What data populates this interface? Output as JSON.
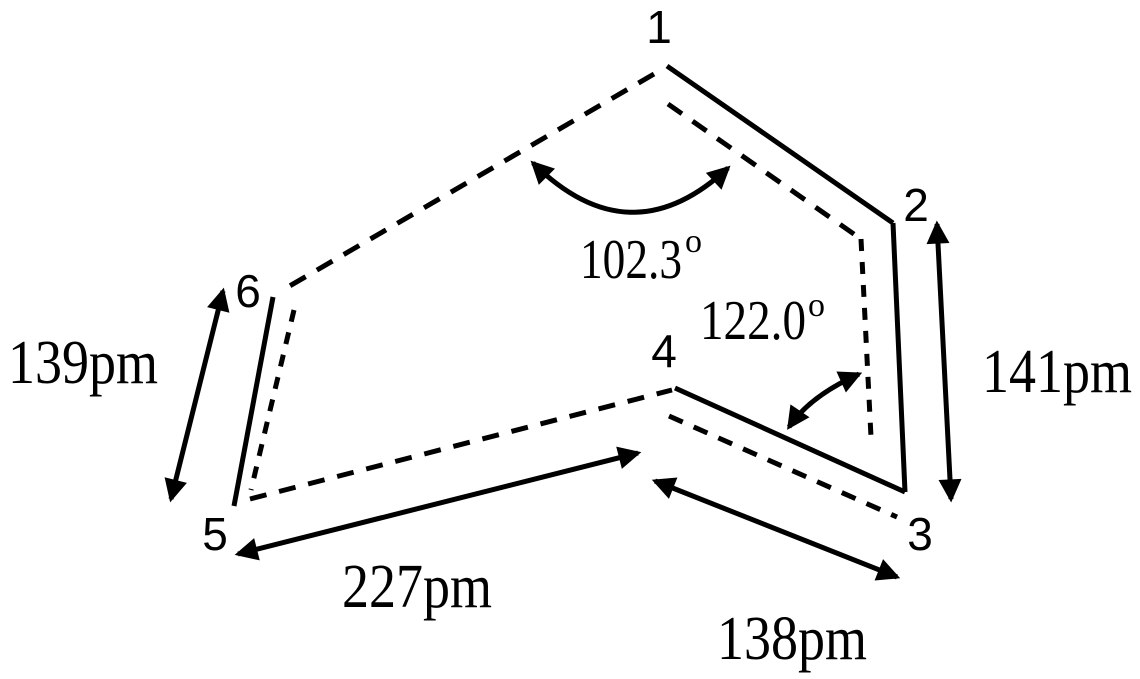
{
  "canvas": {
    "background": "#FFFFFF",
    "ink": "#000000"
  },
  "atoms": [
    {
      "label": "1"
    },
    {
      "label": "2"
    },
    {
      "label": "3"
    },
    {
      "label": "4"
    },
    {
      "label": "5"
    },
    {
      "label": "6"
    }
  ],
  "bond_lengths": [
    {
      "label": "139pm",
      "edge": "6-5",
      "style": "solid"
    },
    {
      "label": "141pm",
      "edge": "2-3",
      "style": "solid"
    },
    {
      "label": "227pm",
      "edge": "5-4",
      "style": "dashed"
    },
    {
      "label": "138pm",
      "edge": "4-3",
      "style": "solid"
    }
  ],
  "angles": [
    {
      "label": "102.3",
      "sup": "o",
      "vertex": "1"
    },
    {
      "label": "122.0",
      "sup": "o",
      "vertex": "3"
    }
  ],
  "edges": {
    "solid": [
      "1-2",
      "2-3",
      "4-3",
      "6-5"
    ],
    "dashed": [
      "1-6",
      "5-4"
    ],
    "dashed_offset_shadows": [
      "1-2",
      "2-3",
      "6-5",
      "4-3"
    ]
  }
}
